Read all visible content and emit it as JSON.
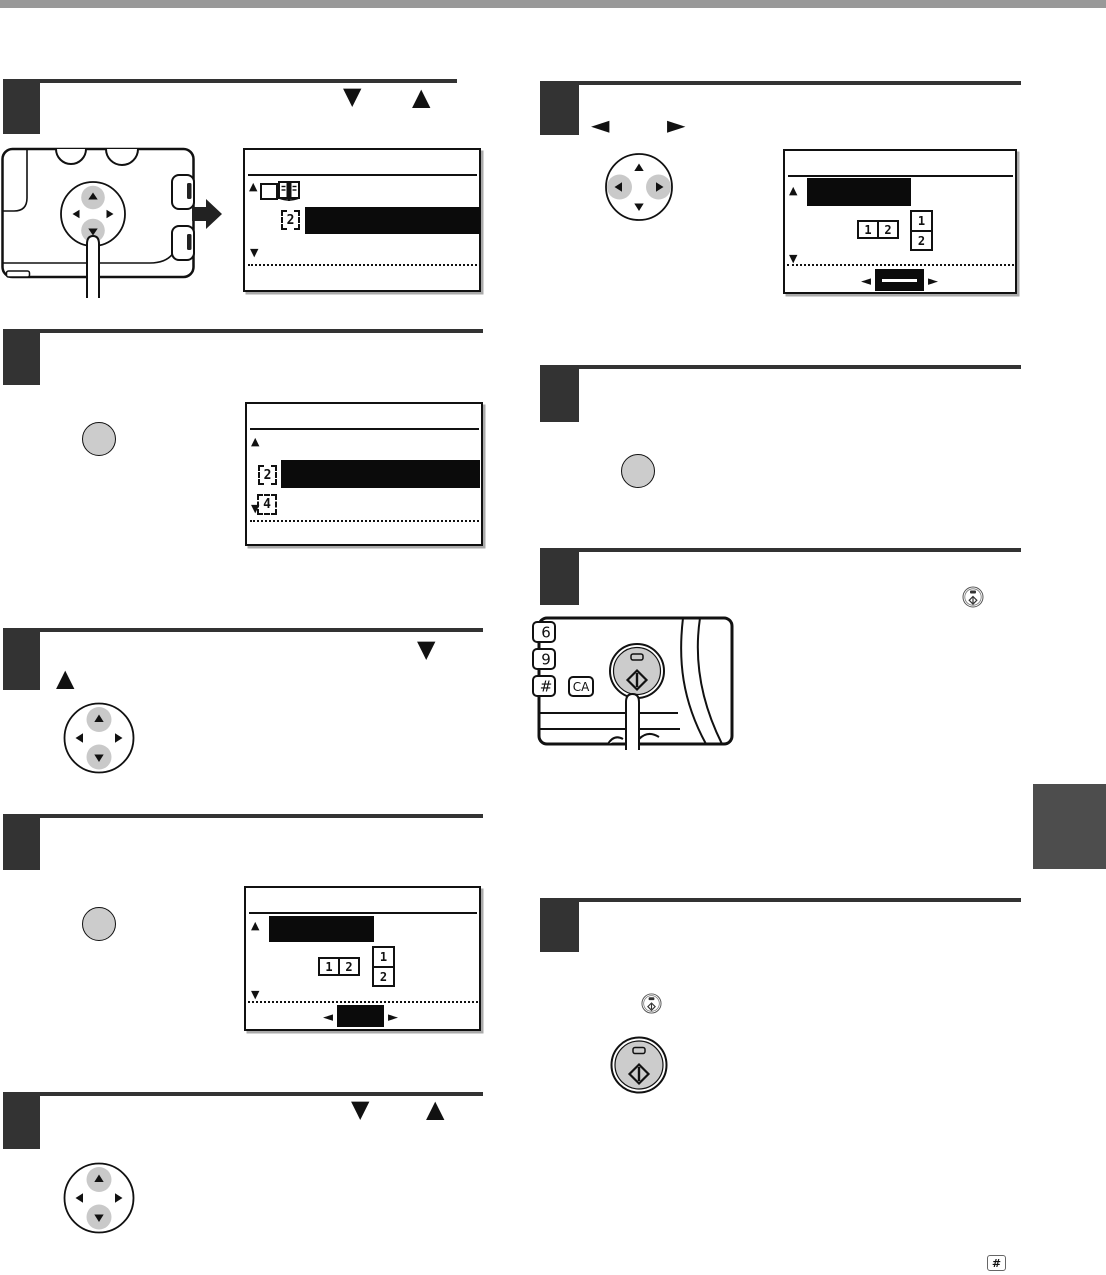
{
  "page": {
    "type": "copier-manual-page",
    "colors": {
      "top_bar": "#999999",
      "step_block": "#333333",
      "side_tab": "#4d4d4d",
      "lcd_highlight": "#0b0b0b",
      "dpad_key_highlight": "#c9c9c9",
      "button_fill": "#cccccc"
    }
  },
  "glyphs": {
    "up": "▲",
    "down": "▼",
    "left": "◄",
    "right": "►"
  },
  "lcd": {
    "two_in_one": "2",
    "four_in_one": "4",
    "pair_left": "1",
    "pair_right": "2",
    "stack_top": "1",
    "stack_bottom": "2"
  },
  "keypad": {
    "key_6": "6",
    "key_9": "9",
    "key_hash": "#",
    "key_ca": "CA"
  },
  "footnote": {
    "hash_key": "#"
  }
}
